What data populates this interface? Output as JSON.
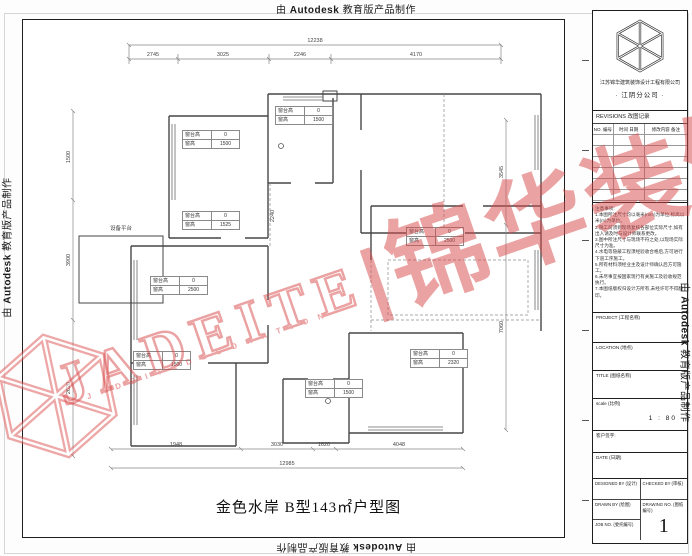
{
  "edge_labels": {
    "prefix": "由",
    "brand": "Autodesk",
    "suffix": "教育版产品制作"
  },
  "watermark": {
    "latin": "JADEITE",
    "separator": "|",
    "cjk": "锦华装饰",
    "subtext": "J A D E I T E   D E C O R A T I O N"
  },
  "plan": {
    "title": "金色水岸 B型143㎡户型图",
    "equipment_platform_label": "设备平台",
    "windows": [
      {
        "sill_label": "窗台高",
        "sill": "0",
        "height_label": "窗高",
        "height": "1500"
      },
      {
        "sill_label": "窗台高",
        "sill": "0",
        "height_label": "窗高",
        "height": "1500"
      },
      {
        "sill_label": "窗台高",
        "sill": "0",
        "height_label": "窗高",
        "height": "1525"
      },
      {
        "sill_label": "窗台高",
        "sill": "0",
        "height_label": "窗高",
        "height": "2500"
      },
      {
        "sill_label": "窗台高",
        "sill": "0",
        "height_label": "窗高",
        "height": "1500"
      },
      {
        "sill_label": "窗台高",
        "sill": "0",
        "height_label": "窗高",
        "height": "2320"
      },
      {
        "sill_label": "窗台高",
        "sill": "0",
        "height_label": "窗高",
        "height": "1500"
      },
      {
        "sill_label": "窗台高",
        "sill": "0",
        "height_label": "窗高",
        "height": "2500"
      }
    ],
    "dims": {
      "top": {
        "total": "12238",
        "segments": [
          "2745",
          "3025",
          "2246",
          "4170"
        ]
      },
      "bottom": {
        "total": "12985",
        "segments": [
          "1948",
          "3030",
          "1620",
          "4048"
        ]
      },
      "left": {
        "segments": [
          "1500",
          "3900",
          "2620"
        ]
      },
      "right": {
        "segments": [
          "3545",
          "7060"
        ]
      },
      "inner": [
        "2240"
      ]
    }
  },
  "titleblock": {
    "company_line1": "江苏锦华建筑装饰设计工程有限公司",
    "company_line2": "·  江阴分公司  ·",
    "revisions_title": "REVISIONS 改图记录",
    "rev_cols": [
      "NO. 编号",
      "时间 日期",
      "修改内容 备注"
    ],
    "notes": "注意事项:\n1.本图所注尺寸均以毫米(mm)为单位,标高以米(m)为单位。\n2.施工前须到现场复核各部位实际尺寸,如有出入请及时与设计师联系更改。\n3.图中所注尺寸与现场不符之处,以现场实际尺寸为准。\n4.水电等隐蔽工程须经验收合格后,方可进行下道工序施工。\n5.所有材料须经业主及设计师确认后方可施工。\n6.未尽事宜按国家现行有关施工及验收规范执行。\n7.本图纸版权归设计方所有,未经许可不得翻印。",
    "fields": {
      "project": "PROJECT (工程名称)",
      "location": "LOCATION (地点)",
      "title": "TITLE (图纸名称)",
      "scale": "scale (比例)",
      "scale_value": "1 : 80",
      "client_sign": "客户签字:",
      "date": "DATE (日期)",
      "designed": "DESIGNED BY (设计)",
      "checked": "CHECKED BY (审核)",
      "drawn": "DRAWN BY (绘图)",
      "drawing_no": "DRAWING NO. (图纸编号)",
      "job_no": "JOB NO. (委托编号)",
      "drawing_no_value": "1"
    }
  }
}
